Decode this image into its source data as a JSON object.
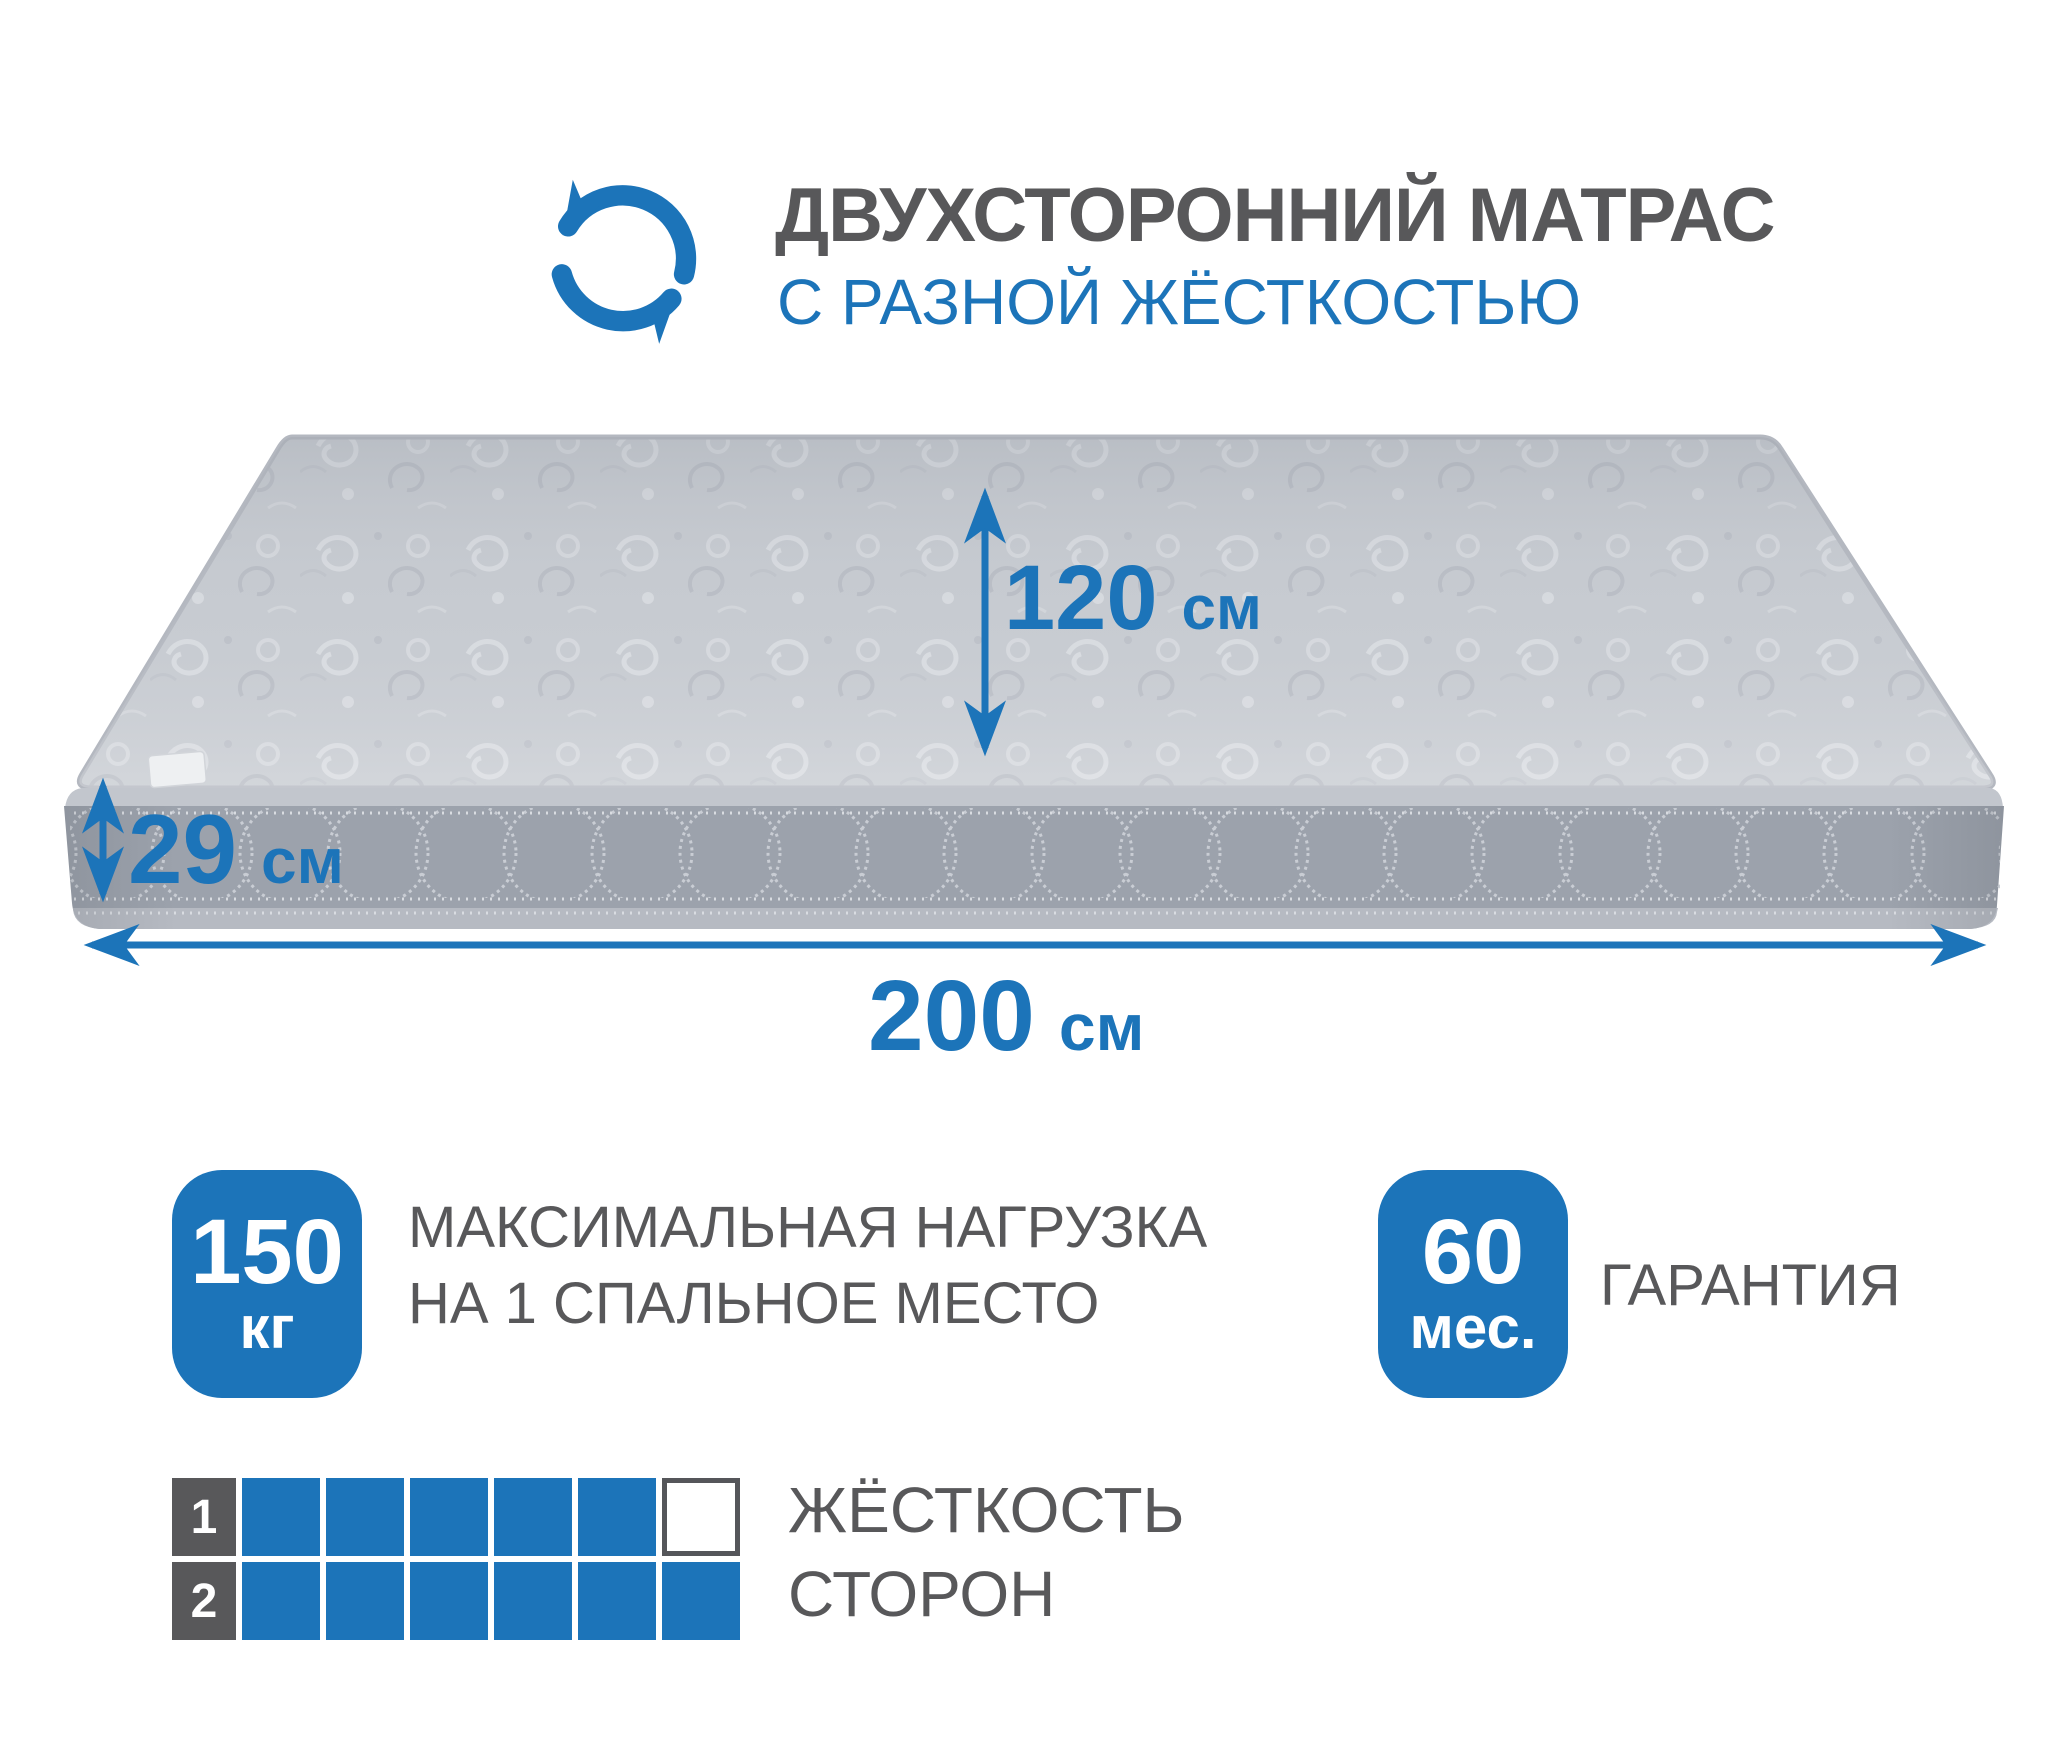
{
  "colors": {
    "accent": "#1c74b9",
    "text_gray": "#58585a"
  },
  "header": {
    "icon": "rotate-arrows-icon",
    "title": "ДВУХСТОРОННИЙ МАТРАС",
    "subtitle": "С РАЗНОЙ ЖЁСТКОСТЬЮ"
  },
  "dimensions": {
    "depth": {
      "value": "120",
      "unit": "см"
    },
    "height": {
      "value": "29",
      "unit": "см"
    },
    "width": {
      "value": "200",
      "unit": "см"
    }
  },
  "max_load": {
    "value": "150",
    "unit": "кг",
    "label_line1": "МАКСИМАЛЬНАЯ НАГРУЗКА",
    "label_line2": "НА 1 СПАЛЬНОЕ МЕСТО"
  },
  "warranty": {
    "value": "60",
    "unit": "мес.",
    "label": "ГАРАНТИЯ"
  },
  "firmness": {
    "label_line1": "ЖЁСТКОСТЬ",
    "label_line2": "СТОРОН",
    "scale_max": 6,
    "sides": [
      {
        "number": "1",
        "filled": 5
      },
      {
        "number": "2",
        "filled": 6
      }
    ]
  }
}
